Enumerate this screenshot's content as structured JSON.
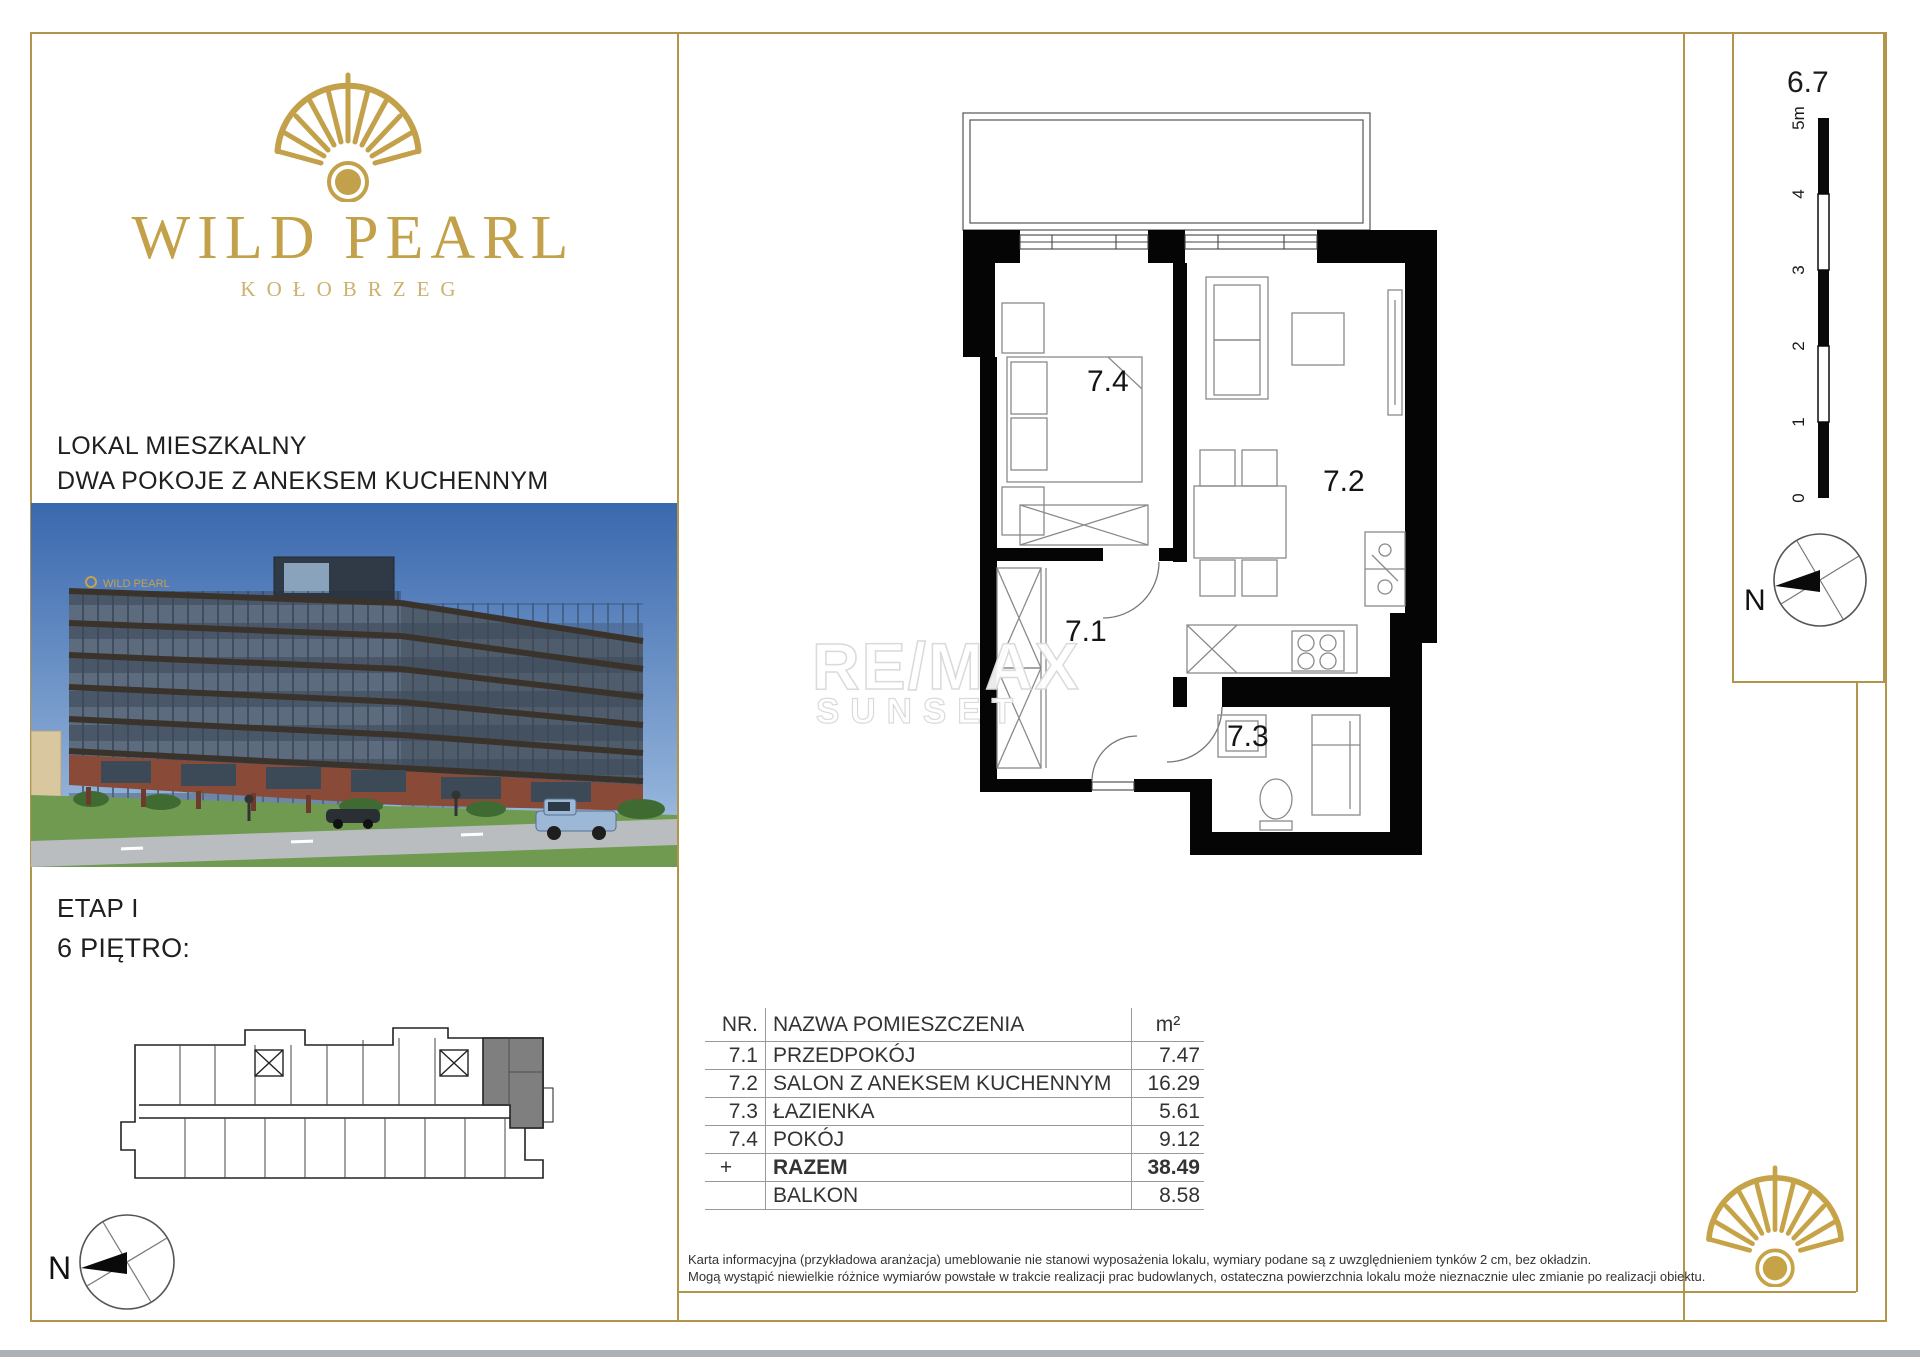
{
  "brand": {
    "name": "WILD PEARL",
    "city": "KOŁOBRZEG"
  },
  "listing": {
    "type_line1": "LOKAL MIESZKALNY",
    "type_line2": "DWA POKOJE Z ANEKSEM KUCHENNYM",
    "stage": "ETAP I",
    "floor": "6 PIĘTRO:"
  },
  "plan": {
    "labels": {
      "hall": "7.1",
      "living": "7.2",
      "bath": "7.3",
      "room": "7.4"
    }
  },
  "scalebar": {
    "title": "6.7",
    "ticks": [
      "5m",
      "4",
      "3",
      "2",
      "1",
      "0"
    ]
  },
  "compass": {
    "label_right": "N",
    "label_left": "N"
  },
  "watermark": {
    "line1": "RE/MAX",
    "line2": "SUNSET"
  },
  "table": {
    "headers": {
      "nr": "NR.",
      "name": "NAZWA POMIESZCZENIA",
      "area": "m²"
    },
    "rows": [
      {
        "nr": "7.1",
        "name": "PRZEDPOKÓJ",
        "area": "7.47"
      },
      {
        "nr": "7.2",
        "name": "SALON Z ANEKSEM KUCHENNYM",
        "area": "16.29"
      },
      {
        "nr": "7.3",
        "name": "ŁAZIENKA",
        "area": "5.61"
      },
      {
        "nr": "7.4",
        "name": "POKÓJ",
        "area": "9.12"
      }
    ],
    "total": {
      "nr": "+",
      "name": "RAZEM",
      "area": "38.49"
    },
    "balcony": {
      "nr": "",
      "name": "BALKON",
      "area": "8.58"
    }
  },
  "footer": {
    "line1": "Karta informacyjna (przykładowa aranżacja) umeblowanie nie stanowi wyposażenia lokalu, wymiary podane są z uwzględnieniem tynków 2 cm, bez okładzin.",
    "line2": "Mogą wystąpić niewielkie różnice wymiarów powstałe w trakcie realizacji prac budowlanych, ostateczna powierzchnia lokalu może nieznacznie ulec zmianie po realizacji obiektu."
  },
  "colors": {
    "gold": "#b2954a",
    "logo_gold": "#c3a04a",
    "unit_highlight": "#7f7f7f"
  }
}
